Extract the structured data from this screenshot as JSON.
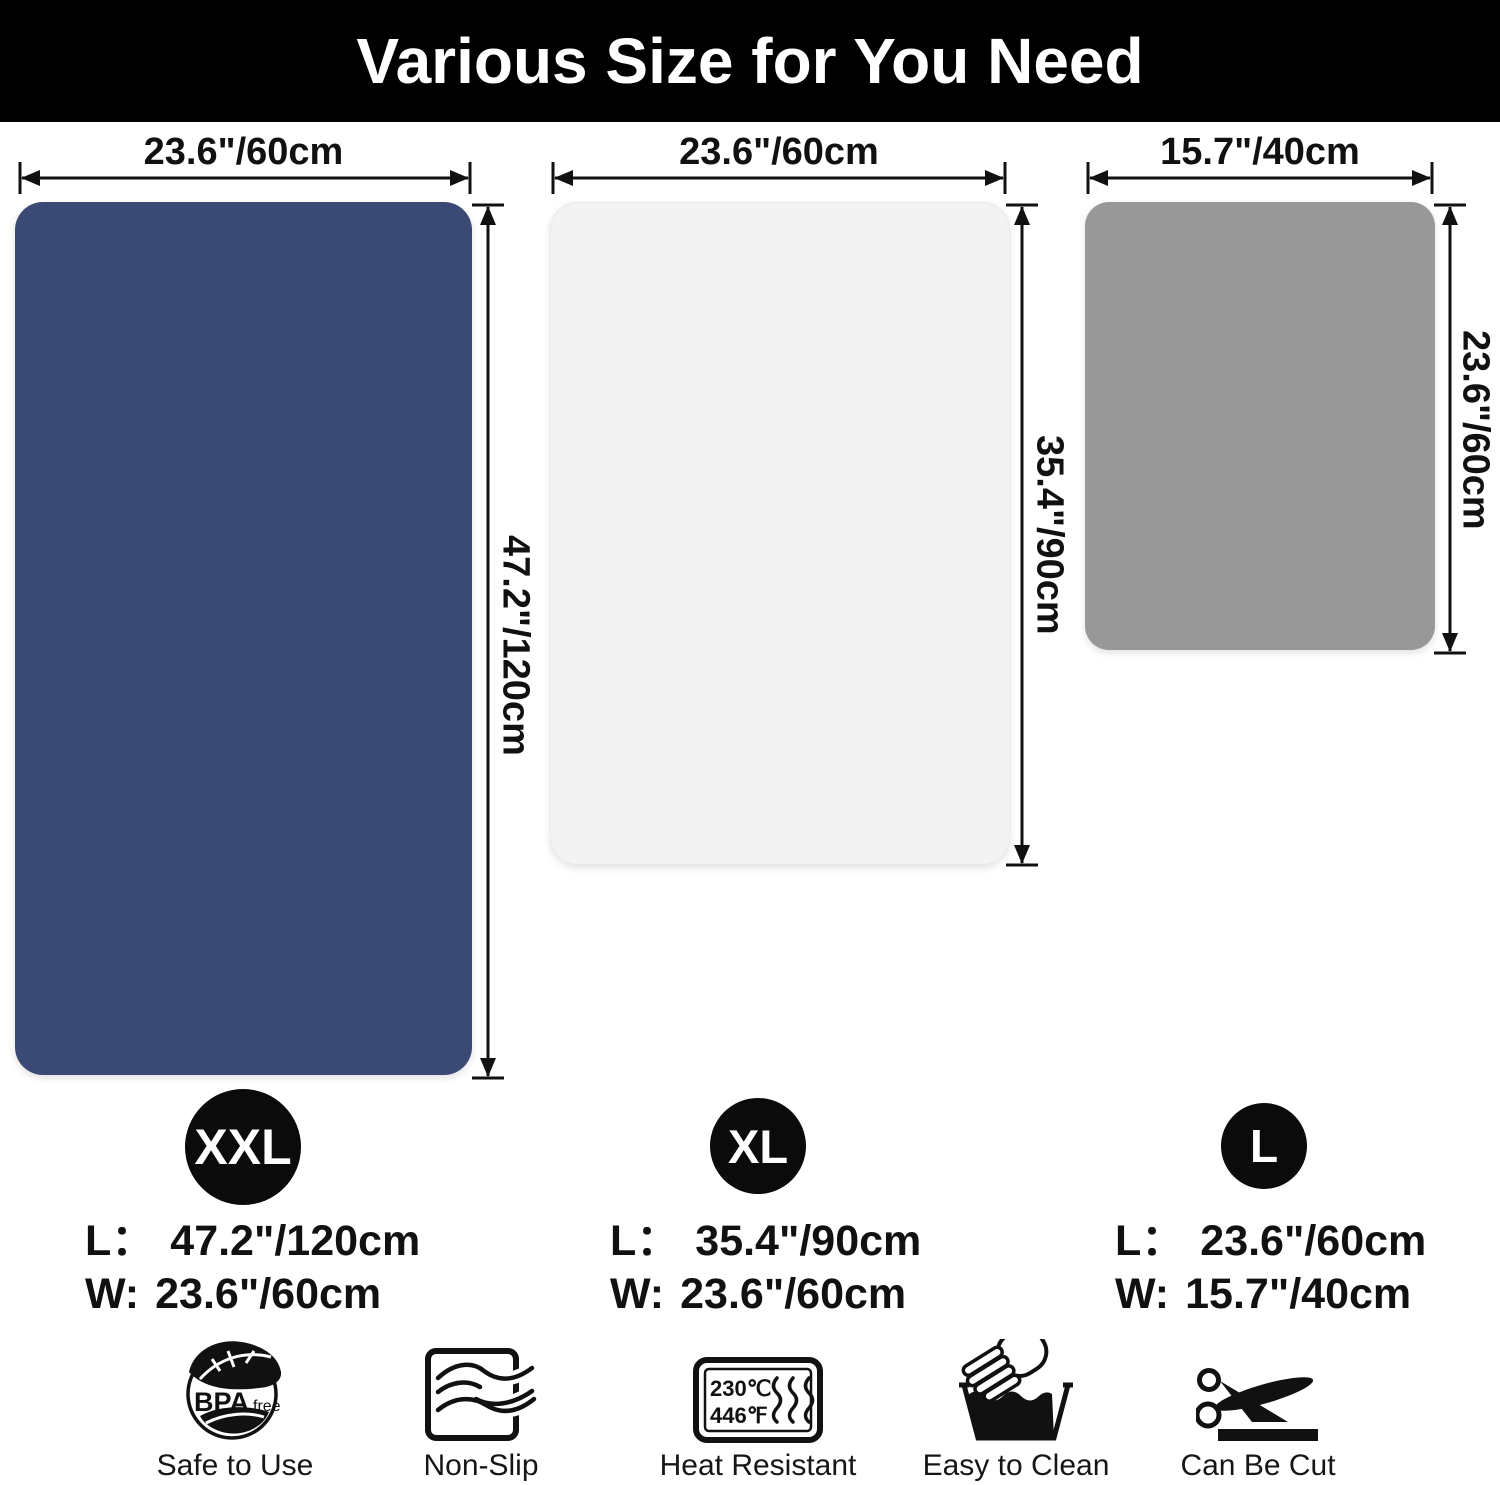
{
  "header": {
    "title": "Various Size for You Need"
  },
  "mats": [
    {
      "name": "XXL mat",
      "badge": "XXL",
      "color": "#3a4a74",
      "top_dim": "23.6\"/60cm",
      "side_dim": "47.2\"/120cm",
      "spec_l_label": "L：",
      "spec_l_value": "47.2\"/120cm",
      "spec_w_label": "W:",
      "spec_w_value": "23.6\"/60cm"
    },
    {
      "name": "XL mat",
      "badge": "XL",
      "color": "#f3f3f3",
      "top_dim": "23.6\"/60cm",
      "side_dim": "35.4\"/90cm",
      "spec_l_label": "L：",
      "spec_l_value": "35.4\"/90cm",
      "spec_w_label": "W:",
      "spec_w_value": "23.6\"/60cm"
    },
    {
      "name": "L mat",
      "badge": "L",
      "color": "#989898",
      "top_dim": "15.7\"/40cm",
      "side_dim": "23.6\"/60cm",
      "spec_l_label": "L：",
      "spec_l_value": "23.6\"/60cm",
      "spec_w_label": "W:",
      "spec_w_value": "15.7\"/40cm"
    }
  ],
  "features": [
    {
      "label": "Safe to Use",
      "icon": "bpa-free-icon",
      "badge_text": "BPA",
      "badge_sub": "free"
    },
    {
      "label": "Non-Slip",
      "icon": "non-slip-icon"
    },
    {
      "label": "Heat Resistant",
      "icon": "heat-resistant-icon",
      "temp_c": "230℃",
      "temp_f": "446℉"
    },
    {
      "label": "Easy to Clean",
      "icon": "easy-to-clean-icon"
    },
    {
      "label": "Can Be Cut",
      "icon": "can-be-cut-icon"
    }
  ],
  "colors": {
    "header_bg": "#000000",
    "badge_bg": "#0b0b0b",
    "ink": "#111111"
  }
}
